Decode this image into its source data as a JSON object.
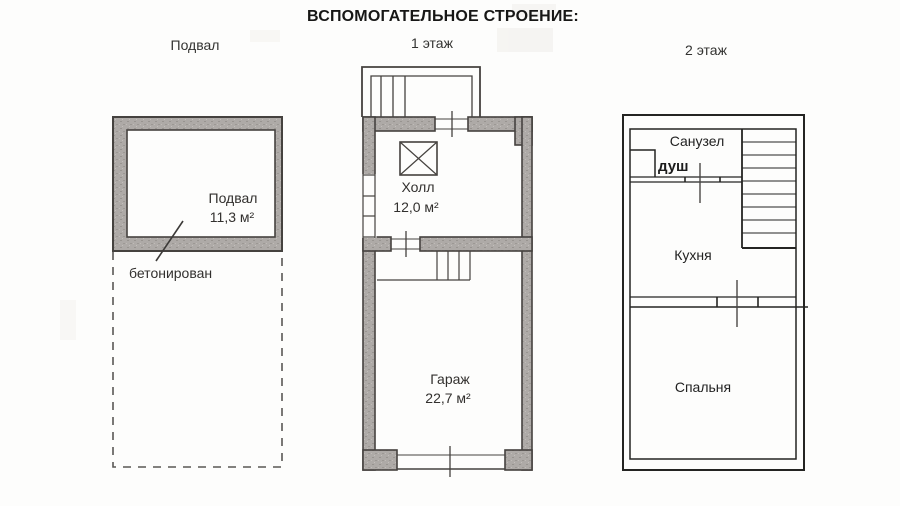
{
  "title": "ВСПОМОГАТЕЛЬНОЕ СТРОЕНИЕ:",
  "columns": {
    "basement_label": "Подвал",
    "first_label": "1 этаж",
    "second_label": "2 этаж"
  },
  "basement": {
    "room_name": "Подвал",
    "room_area": "11,3 м²",
    "note": "бетонирован"
  },
  "first_floor": {
    "hall_name": "Холл",
    "hall_area": "12,0 м²",
    "garage_name": "Гараж",
    "garage_area": "22,7 м²"
  },
  "second_floor": {
    "bathroom": "Санузел",
    "shower": "душ",
    "kitchen": "Кухня",
    "bedroom": "Спальня"
  },
  "colors": {
    "line": "#45423f",
    "line_dark": "#242422",
    "wall_fill": "#aeaaa7",
    "background": "#fdfdfc"
  }
}
